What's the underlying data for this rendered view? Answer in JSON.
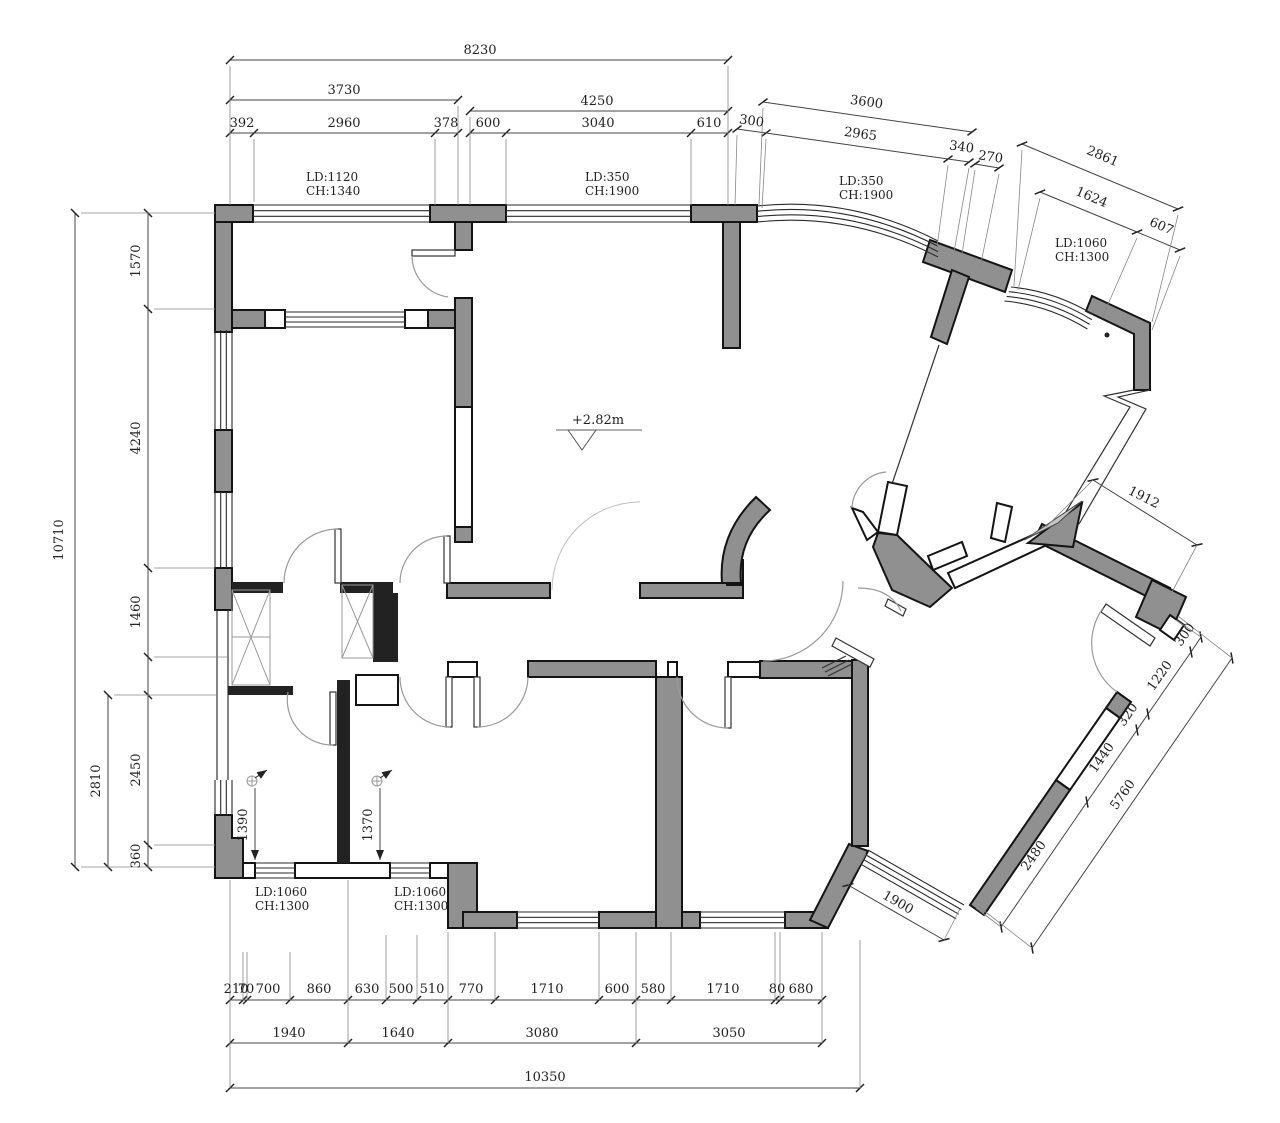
{
  "drawing": {
    "type": "architectural-floor-plan",
    "units": "mm",
    "colors": {
      "wall_fill": "#909090",
      "wall_line": "#141414",
      "dim_line": "#444444",
      "text": "#222222",
      "door_arc": "#9a9a9a"
    },
    "level_mark_text": "+2.82m",
    "labels": [
      {
        "t": "8230",
        "x": 480,
        "y": 54
      },
      {
        "t": "3730",
        "x": 344,
        "y": 94
      },
      {
        "t": "4250",
        "x": 597,
        "y": 105
      },
      {
        "t": "392",
        "x": 242,
        "y": 127
      },
      {
        "t": "2960",
        "x": 344,
        "y": 127
      },
      {
        "t": "378",
        "x": 446,
        "y": 127
      },
      {
        "t": "600",
        "x": 488,
        "y": 127
      },
      {
        "t": "3040",
        "x": 598,
        "y": 127
      },
      {
        "t": "610",
        "x": 709,
        "y": 127
      },
      {
        "t": "3600",
        "x": 866,
        "y": 106,
        "r": 8
      },
      {
        "t": "300",
        "x": 751,
        "y": 125,
        "r": 8
      },
      {
        "t": "2965",
        "x": 860,
        "y": 138,
        "r": 8
      },
      {
        "t": "340",
        "x": 961,
        "y": 151,
        "r": 8
      },
      {
        "t": "270",
        "x": 990,
        "y": 161,
        "r": 8
      },
      {
        "t": "2861",
        "x": 1101,
        "y": 160,
        "r": 23
      },
      {
        "t": "1624",
        "x": 1090,
        "y": 201,
        "r": 23
      },
      {
        "t": "607",
        "x": 1160,
        "y": 230,
        "r": 23
      },
      {
        "t": "10710",
        "x": 63,
        "y": 540,
        "r": -90
      },
      {
        "t": "1570",
        "x": 140,
        "y": 261,
        "r": -90
      },
      {
        "t": "4240",
        "x": 140,
        "y": 438,
        "r": -90
      },
      {
        "t": "1460",
        "x": 140,
        "y": 612,
        "r": -90
      },
      {
        "t": "2450",
        "x": 140,
        "y": 770,
        "r": -90
      },
      {
        "t": "360",
        "x": 140,
        "y": 856,
        "r": -90
      },
      {
        "t": "2810",
        "x": 100,
        "y": 781,
        "r": -90
      },
      {
        "t": "210",
        "x": 236,
        "y": 993
      },
      {
        "t": "70",
        "x": 246,
        "y": 993
      },
      {
        "t": "700",
        "x": 268,
        "y": 993
      },
      {
        "t": "860",
        "x": 319,
        "y": 993
      },
      {
        "t": "630",
        "x": 367,
        "y": 993
      },
      {
        "t": "500",
        "x": 401,
        "y": 993
      },
      {
        "t": "510",
        "x": 432,
        "y": 993
      },
      {
        "t": "770",
        "x": 471,
        "y": 993
      },
      {
        "t": "1710",
        "x": 547,
        "y": 993
      },
      {
        "t": "600",
        "x": 617,
        "y": 993
      },
      {
        "t": "580",
        "x": 653,
        "y": 993
      },
      {
        "t": "1710",
        "x": 723,
        "y": 993
      },
      {
        "t": "80",
        "x": 777,
        "y": 993
      },
      {
        "t": "680",
        "x": 801,
        "y": 993
      },
      {
        "t": "1940",
        "x": 289,
        "y": 1037
      },
      {
        "t": "1640",
        "x": 398,
        "y": 1037
      },
      {
        "t": "3080",
        "x": 542,
        "y": 1037
      },
      {
        "t": "3050",
        "x": 729,
        "y": 1037
      },
      {
        "t": "10350",
        "x": 545,
        "y": 1081
      },
      {
        "t": "300",
        "x": 1188,
        "y": 637,
        "r": -55
      },
      {
        "t": "1220",
        "x": 1163,
        "y": 678,
        "r": -55
      },
      {
        "t": "320",
        "x": 1131,
        "y": 717,
        "r": -55
      },
      {
        "t": "1440",
        "x": 1105,
        "y": 760,
        "r": -55
      },
      {
        "t": "2480",
        "x": 1037,
        "y": 858,
        "r": -55
      },
      {
        "t": "5760",
        "x": 1126,
        "y": 797,
        "r": -55
      },
      {
        "t": "1912",
        "x": 1142,
        "y": 501,
        "r": 27
      },
      {
        "t": "1900",
        "x": 896,
        "y": 906,
        "r": 30
      },
      {
        "t": "1390",
        "x": 247,
        "y": 825,
        "r": -90
      },
      {
        "t": "1370",
        "x": 372,
        "y": 825,
        "r": -90
      },
      {
        "t": "LD:1120",
        "x": 306,
        "y": 181,
        "a": "s",
        "k": "window-label"
      },
      {
        "t": "CH:1340",
        "x": 306,
        "y": 195,
        "a": "s",
        "k": "window-label"
      },
      {
        "t": "LD:350",
        "x": 585,
        "y": 181,
        "a": "s",
        "k": "window-label"
      },
      {
        "t": "CH:1900",
        "x": 585,
        "y": 195,
        "a": "s",
        "k": "window-label"
      },
      {
        "t": "LD:350",
        "x": 839,
        "y": 185,
        "a": "s",
        "k": "window-label"
      },
      {
        "t": "CH:1900",
        "x": 839,
        "y": 199,
        "a": "s",
        "k": "window-label"
      },
      {
        "t": "LD:1060",
        "x": 1055,
        "y": 247,
        "a": "s",
        "k": "window-label"
      },
      {
        "t": "CH:1300",
        "x": 1055,
        "y": 261,
        "a": "s",
        "k": "window-label"
      },
      {
        "t": "LD:1060",
        "x": 255,
        "y": 896,
        "a": "s",
        "k": "window-label"
      },
      {
        "t": "CH:1300",
        "x": 255,
        "y": 910,
        "a": "s",
        "k": "window-label"
      },
      {
        "t": "LD:1060",
        "x": 394,
        "y": 896,
        "a": "s",
        "k": "window-label"
      },
      {
        "t": "CH:1300",
        "x": 394,
        "y": 910,
        "a": "s",
        "k": "window-label"
      },
      {
        "t": "+2.82m",
        "x": 598,
        "y": 424,
        "k": "level-mark"
      }
    ]
  }
}
